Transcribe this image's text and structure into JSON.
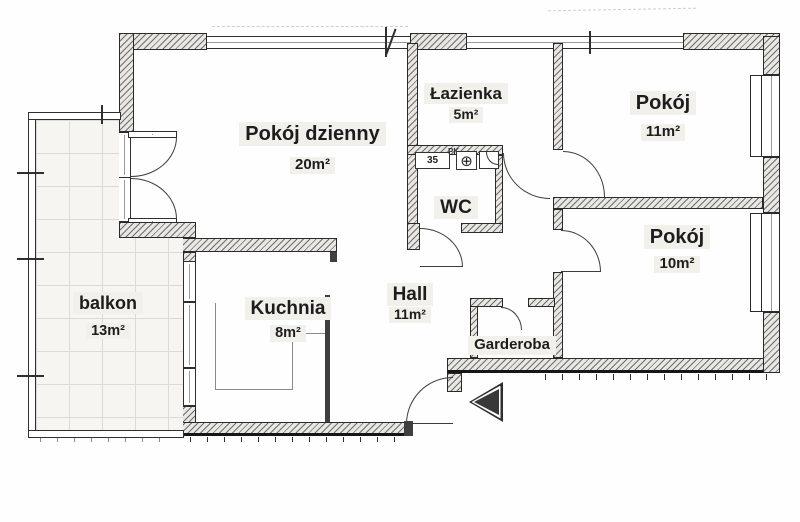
{
  "floorplan": {
    "type": "apartment-floor-plan",
    "rooms": [
      {
        "id": "living-room",
        "name": "Pokój dzienny",
        "area": "20m²"
      },
      {
        "id": "bathroom",
        "name": "Łazienka",
        "area": "5m²"
      },
      {
        "id": "room-11",
        "name": "Pokój",
        "area": "11m²"
      },
      {
        "id": "wc",
        "name": "WC",
        "area": ""
      },
      {
        "id": "room-10",
        "name": "Pokój",
        "area": "10m²"
      },
      {
        "id": "balcony",
        "name": "balkon",
        "area": "13m²"
      },
      {
        "id": "kitchen",
        "name": "Kuchnia",
        "area": "8m²"
      },
      {
        "id": "hall",
        "name": "Hall",
        "area": "11m²"
      },
      {
        "id": "wardrobe",
        "name": "Garderoba",
        "area": ""
      }
    ],
    "fixtures": {
      "cabinet_label": "35",
      "cabinet_note": "PK"
    },
    "colors": {
      "wall_line": "#2a2a2a",
      "hatch_fill": "#e9e7e3",
      "label_text": "#1d1d1d",
      "label_bg": "#f2f0eb",
      "tile_line": "#dcdad5",
      "arrow": "#343434"
    }
  }
}
